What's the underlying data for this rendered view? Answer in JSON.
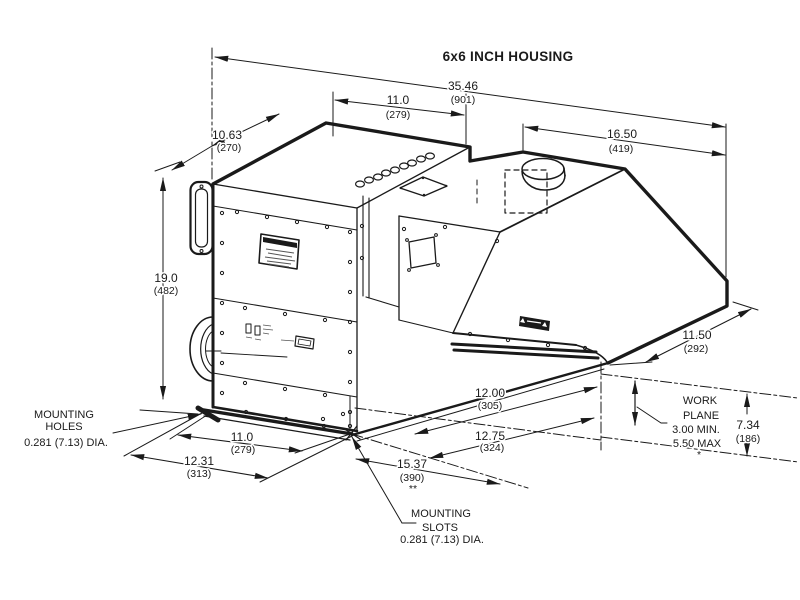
{
  "title": "6x6 INCH HOUSING",
  "colors": {
    "line": "#1a1a1a",
    "background": "#ffffff"
  },
  "dimensions": {
    "overall_width": {
      "value": "35.46",
      "mm": "(901)"
    },
    "top_inner_width": {
      "value": "11.0",
      "mm": "(279)"
    },
    "left_depth": {
      "value": "10.63",
      "mm": "(270)"
    },
    "left_height": {
      "value": "19.0",
      "mm": "(482)"
    },
    "right_top_width": {
      "value": "16.50",
      "mm": "(419)"
    },
    "right_side_depth": {
      "value": "11.50",
      "mm": "(292)"
    },
    "work_plane_height": {
      "value": "7.34",
      "mm": "(186)"
    },
    "base_front_width": {
      "value": "11.0",
      "mm": "(279)"
    },
    "base_front_overall": {
      "value": "12.31",
      "mm": "(313)"
    },
    "base_right_inner": {
      "value": "12.00",
      "mm": "(305)"
    },
    "base_right_outer": {
      "value": "12.75",
      "mm": "(324)"
    },
    "base_diagonal": {
      "value": "15.37",
      "mm": "(390)",
      "note": "**"
    }
  },
  "annotations": {
    "mounting_holes": {
      "line1": "MOUNTING",
      "line2": "HOLES",
      "line3": "0.281 (7.13) DIA."
    },
    "mounting_slots": {
      "line1": "MOUNTING",
      "line2": "SLOTS",
      "line3": "0.281 (7.13) DIA."
    },
    "work_plane": {
      "line1": "WORK",
      "line2": "PLANE",
      "line3": "3.00 MIN.",
      "line4": "5.50 MAX",
      "note": "*"
    }
  }
}
